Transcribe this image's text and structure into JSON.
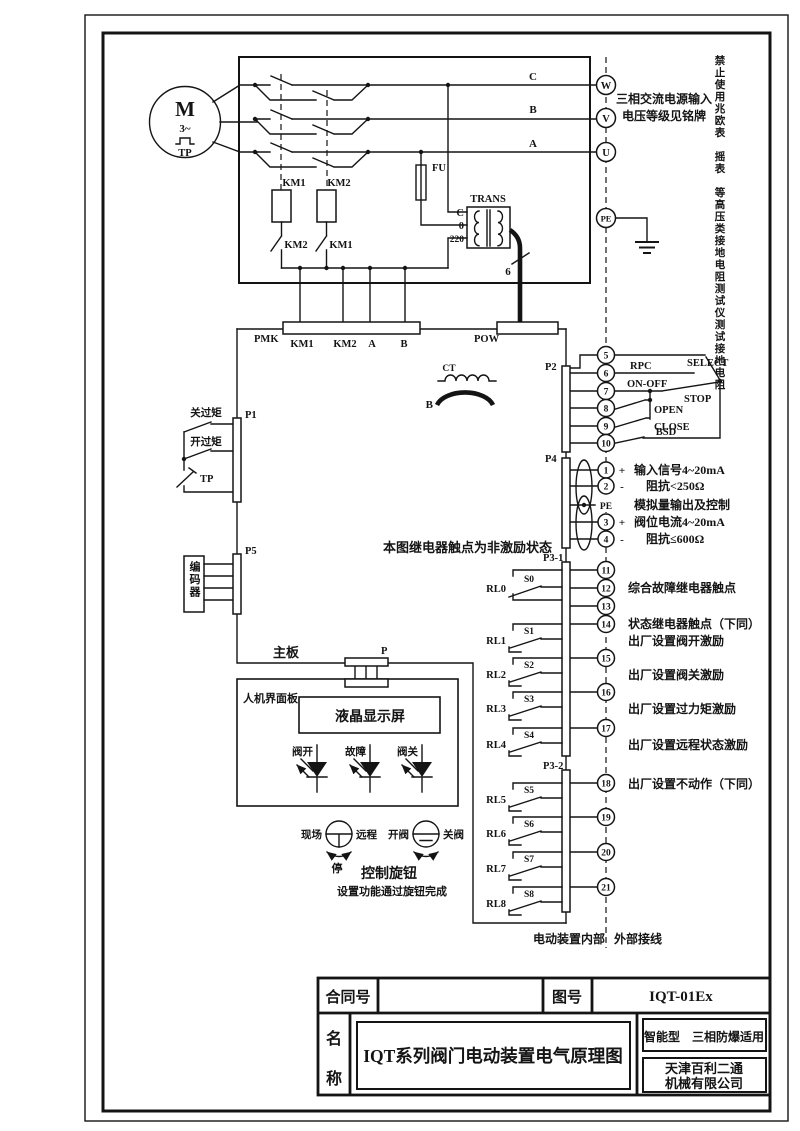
{
  "frame": {
    "warning_vertical": "禁止使用兆欧表　摇表　等高压类接地电阻测试仪测试接地电阻"
  },
  "motor": {
    "m": "M",
    "phase": "3~",
    "tp": "TP"
  },
  "power": {
    "phase_c": "C",
    "phase_b": "B",
    "phase_a": "A",
    "t_w": "W",
    "t_v": "V",
    "t_u": "U",
    "t_pe": "PE",
    "note1": "三相交流电源输入",
    "note2": "电压等级见铭牌"
  },
  "contactor": {
    "km1": "KM1",
    "km2": "KM2",
    "km2_nc": "KM2",
    "km1_nc": "KM1",
    "fu": "FU"
  },
  "trans": {
    "name": "TRANS",
    "tap_c": "C",
    "tap_0": "0",
    "tap_220": "220",
    "wires": "6"
  },
  "ct": {
    "name": "CT",
    "phase": "B"
  },
  "board": {
    "pmk": "PMK",
    "pin_km1": "KM1",
    "pin_km2": "KM2",
    "pin_a": "A",
    "pin_b": "B",
    "pow": "POW",
    "main": "主板",
    "p": "P",
    "note": "本图继电器触点为非激励状态"
  },
  "p1": {
    "name": "P1",
    "close_torque": "关过矩",
    "open_torque": "开过矩",
    "tp": "TP"
  },
  "p5": {
    "name": "P5",
    "encoder": "编码器"
  },
  "p2": {
    "name": "P2",
    "t": [
      "5",
      "6",
      "7",
      "8",
      "9",
      "10"
    ],
    "rpc": "RPC",
    "onoff": "ON-OFF",
    "open": "OPEN",
    "close": "CLOSE",
    "bsd": "BSD",
    "select": "SELECT",
    "stop": "STOP"
  },
  "p4": {
    "name": "P4",
    "t": [
      "1",
      "2",
      "3",
      "4"
    ],
    "pe": "PE",
    "plus1": "+",
    "minus1": "-",
    "plus2": "+",
    "minus2": "-",
    "sig": "输入信号4~20mA",
    "imp_in": "阻抗<250Ω",
    "analog": "模拟量输出及控制",
    "pos": "阀位电流4~20mA",
    "imp_out": "阻抗≤600Ω"
  },
  "p31": {
    "name": "P3-1",
    "t": [
      "11",
      "12",
      "13",
      "14",
      "15",
      "16",
      "17"
    ],
    "rl": [
      "RL0",
      "RL1",
      "RL2",
      "RL3",
      "RL4"
    ],
    "s": [
      "S0",
      "S1",
      "S2",
      "S3",
      "S4"
    ],
    "a_fault": "综合故障继电器触点",
    "a_status": "状态继电器触点（下同）",
    "a_open": "出厂设置阀开激励",
    "a_close": "出厂设置阀关激励",
    "a_torque": "出厂设置过力矩激励",
    "a_remote": "出厂设置远程状态激励"
  },
  "p32": {
    "name": "P3-2",
    "t": [
      "18",
      "19",
      "20",
      "21"
    ],
    "rl": [
      "RL5",
      "RL6",
      "RL7",
      "RL8"
    ],
    "s": [
      "S5",
      "S6",
      "S7",
      "S8"
    ],
    "a_noact": "出厂设置不动作（下同）"
  },
  "zones": {
    "internal": "电动装置内部",
    "external": "外部接线"
  },
  "hmi": {
    "panel": "人机界面板",
    "lcd": "液晶显示屏",
    "led_open": "阀开",
    "led_fault": "故障",
    "led_close": "阀关"
  },
  "knob": {
    "local": "现场",
    "remote": "远程",
    "stop": "停",
    "open": "开阀",
    "close": "关阀",
    "title": "控制旋钮",
    "note": "设置功能通过旋钮完成"
  },
  "titleblock": {
    "contract": "合同号",
    "fig_label": "图号",
    "fig_no": "IQT-01Ex",
    "name1": "名",
    "name2": "称",
    "drawing": "IQT系列阀门电动装置电气原理图",
    "type": "智能型　三相防爆适用",
    "company1": "天津百利二通",
    "company2": "机械有限公司"
  }
}
